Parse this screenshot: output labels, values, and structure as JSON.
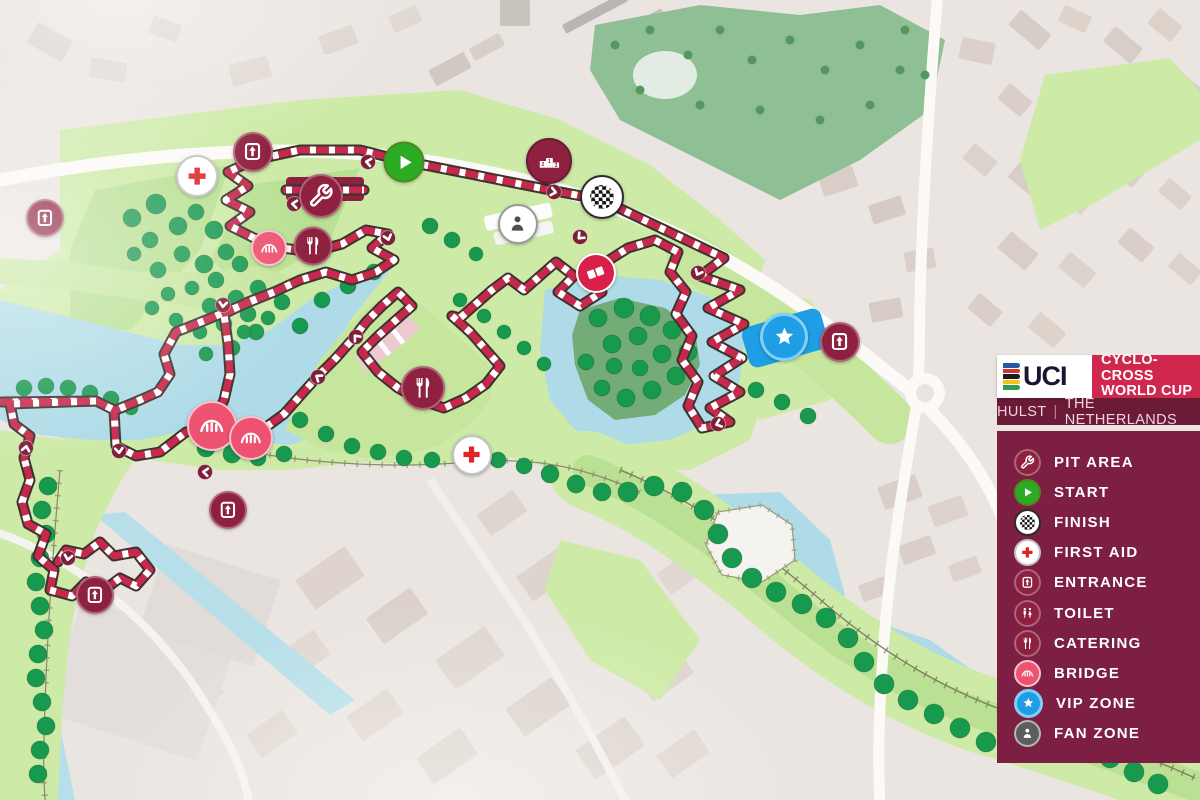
{
  "header": {
    "logo": "UCI",
    "title_line1": "CYCLO-CROSS",
    "title_line2": "WORLD CUP",
    "city": "HULST",
    "divider": "|",
    "country": "THE NETHERLANDS"
  },
  "legend": {
    "items": [
      {
        "id": "pit-area",
        "label": "PIT AREA"
      },
      {
        "id": "start",
        "label": "START"
      },
      {
        "id": "finish",
        "label": "FINISH"
      },
      {
        "id": "first-aid",
        "label": "FIRST AID"
      },
      {
        "id": "entrance",
        "label": "ENTRANCE"
      },
      {
        "id": "toilet",
        "label": "TOILET"
      },
      {
        "id": "catering",
        "label": "CATERING"
      },
      {
        "id": "bridge",
        "label": "BRIDGE"
      },
      {
        "id": "vip-zone",
        "label": "VIP ZONE"
      },
      {
        "id": "fan-zone",
        "label": "FAN ZONE"
      }
    ]
  },
  "map": {
    "podium": {
      "second": "2",
      "first": "1",
      "third": "3"
    },
    "markers": [
      {
        "type": "entrance",
        "x": 45,
        "y": 218,
        "s": 34
      },
      {
        "type": "first-aid",
        "x": 197,
        "y": 176,
        "s": 38
      },
      {
        "type": "entrance",
        "x": 253,
        "y": 152,
        "s": 36
      },
      {
        "type": "pit-area",
        "x": 321,
        "y": 196,
        "s": 40
      },
      {
        "type": "start",
        "x": 404,
        "y": 162,
        "s": 37
      },
      {
        "type": "podium",
        "x": 549,
        "y": 161,
        "s": 42
      },
      {
        "type": "fan-zone",
        "x": 518,
        "y": 224,
        "s": 36
      },
      {
        "type": "finish",
        "x": 602,
        "y": 197,
        "s": 40
      },
      {
        "type": "barriers",
        "x": 596,
        "y": 273,
        "s": 36
      },
      {
        "type": "bridge",
        "x": 269,
        "y": 248,
        "s": 32
      },
      {
        "type": "catering",
        "x": 313,
        "y": 246,
        "s": 35
      },
      {
        "type": "vip-zone",
        "x": 784,
        "y": 337,
        "s": 42
      },
      {
        "type": "entrance",
        "x": 840,
        "y": 342,
        "s": 36
      },
      {
        "type": "bridge",
        "x": 212,
        "y": 426,
        "s": 46
      },
      {
        "type": "bridge",
        "x": 251,
        "y": 438,
        "s": 40
      },
      {
        "type": "catering",
        "x": 423,
        "y": 388,
        "s": 40
      },
      {
        "type": "first-aid",
        "x": 472,
        "y": 455,
        "s": 36
      },
      {
        "type": "entrance",
        "x": 228,
        "y": 510,
        "s": 34
      },
      {
        "type": "entrance",
        "x": 95,
        "y": 595,
        "s": 34
      }
    ],
    "colors": {
      "course_red": "#c6294b",
      "course_casing": "#3b332e",
      "panel": "#7c1f42",
      "panel_dark": "#6b1a37",
      "accent_red": "#d0274e",
      "water": "#aedbe7",
      "park_light": "#cdeaa6",
      "park_sage": "#8fbf94",
      "tree_green": "#17994e",
      "vip_blue": "#1f9ee5",
      "start_green": "#2cab25",
      "bridge_pink": "#ee5271",
      "marker_maroon": "#8e2040"
    }
  }
}
